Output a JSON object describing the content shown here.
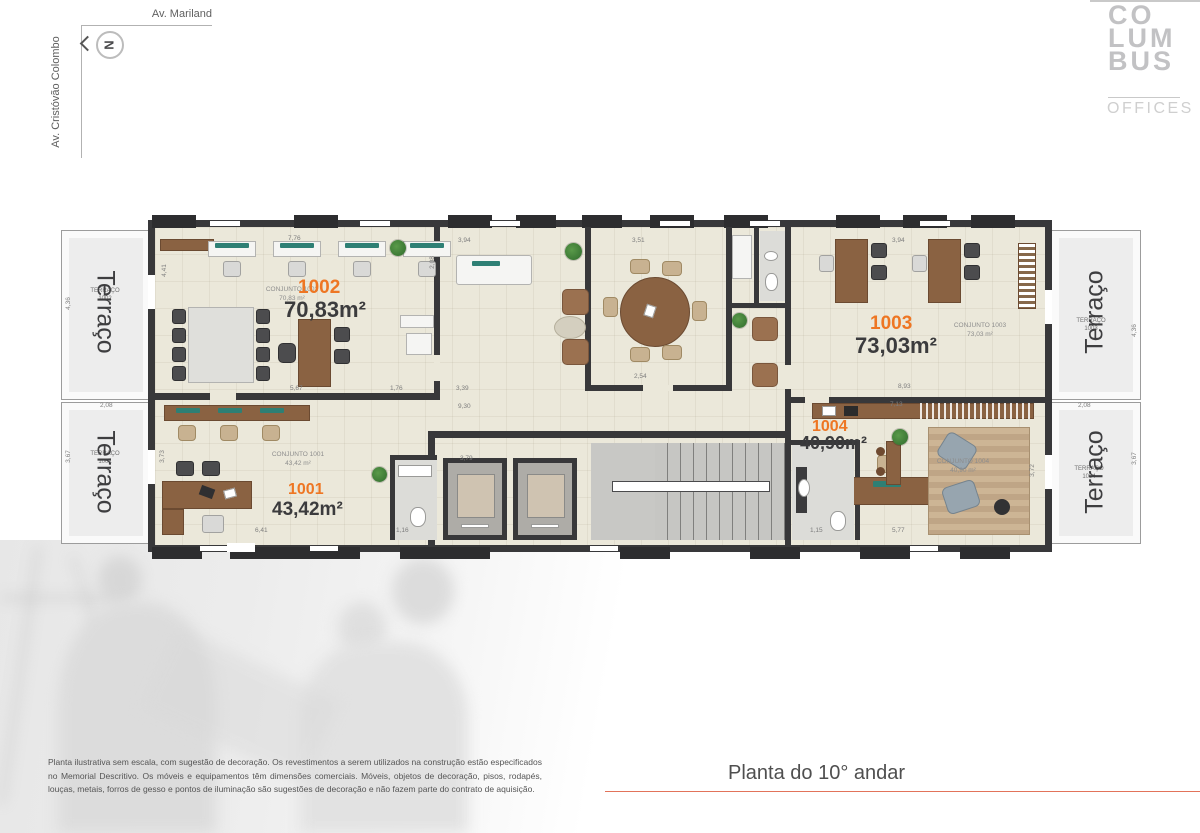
{
  "brand": {
    "l1": "CO",
    "l2": "LUM",
    "l3": "BUS",
    "sub": "OFFICES"
  },
  "streets": {
    "top": "Av. Mariland",
    "left": "Av. Cristóvão Colombo"
  },
  "compass": {
    "letter": "N"
  },
  "plan": {
    "units": {
      "u1001": {
        "num": "1001",
        "area": "43,42m²",
        "conjunto": "CONJUNTO 1001",
        "conjunto_area": "43,42 m²"
      },
      "u1002": {
        "num": "1002",
        "area": "70,83m²",
        "conjunto": "CONJUNTO 1002",
        "conjunto_area": "70,83 m²"
      },
      "u1003": {
        "num": "1003",
        "area": "73,03m²",
        "conjunto": "CONJUNTO 1003",
        "conjunto_area": "73,03 m²"
      },
      "u1004": {
        "num": "1004",
        "area": "40,90m²",
        "conjunto": "CONJUNTO 1004",
        "conjunto_area": "40,90 m²"
      }
    },
    "terraces": {
      "t1002": {
        "big": "Terraço",
        "small": "TERRAÇO",
        "num": "1002"
      },
      "t1001": {
        "big": "Terraço",
        "small": "TERRAÇO",
        "num": "1001"
      },
      "t1003": {
        "big": "Terraço",
        "small": "TERRAÇO",
        "num": "1003"
      },
      "t1004": {
        "big": "Terraço",
        "small": "TERRAÇO",
        "num": "1004"
      }
    },
    "dims": {
      "d1": "7,76",
      "d2": "3,94",
      "d3": "3,51",
      "d4": "3,94",
      "d5": "2,54",
      "d6": "3,39",
      "d7": "9,30",
      "d8": "1,76",
      "d9": "5,67",
      "d10": "4,41",
      "d11": "2,08",
      "d12": "4,36",
      "d13": "4,36",
      "d14": "2,08",
      "d15": "2,08",
      "d16": "3,67",
      "d17": "3,67",
      "d18": "3,73",
      "d19": "3,79",
      "d20": "6,41",
      "d21": "1,16",
      "d22": "5,77",
      "d23": "1,15",
      "d24": "7,13",
      "d25": "3,72",
      "d26": "8,93"
    }
  },
  "footer": {
    "title": "Planta do 10° andar",
    "disclaimer": "Planta ilustrativa sem escala, com sugestão de decoração. Os revestimentos a serem utilizados na construção estão especificados no Memorial Descritivo. Os móveis e equipamentos têm dimensões comerciais. Móveis, objetos de decoração, pisos, rodapés, louças, metais, forros de gesso e pontos de iluminação são sugestões de decoração e não fazem parte do contrato de aquisição."
  },
  "colors": {
    "accent": "#ee7623",
    "wall": "#38383a",
    "floor": "#ebe8da",
    "underline": "#e2735a"
  }
}
